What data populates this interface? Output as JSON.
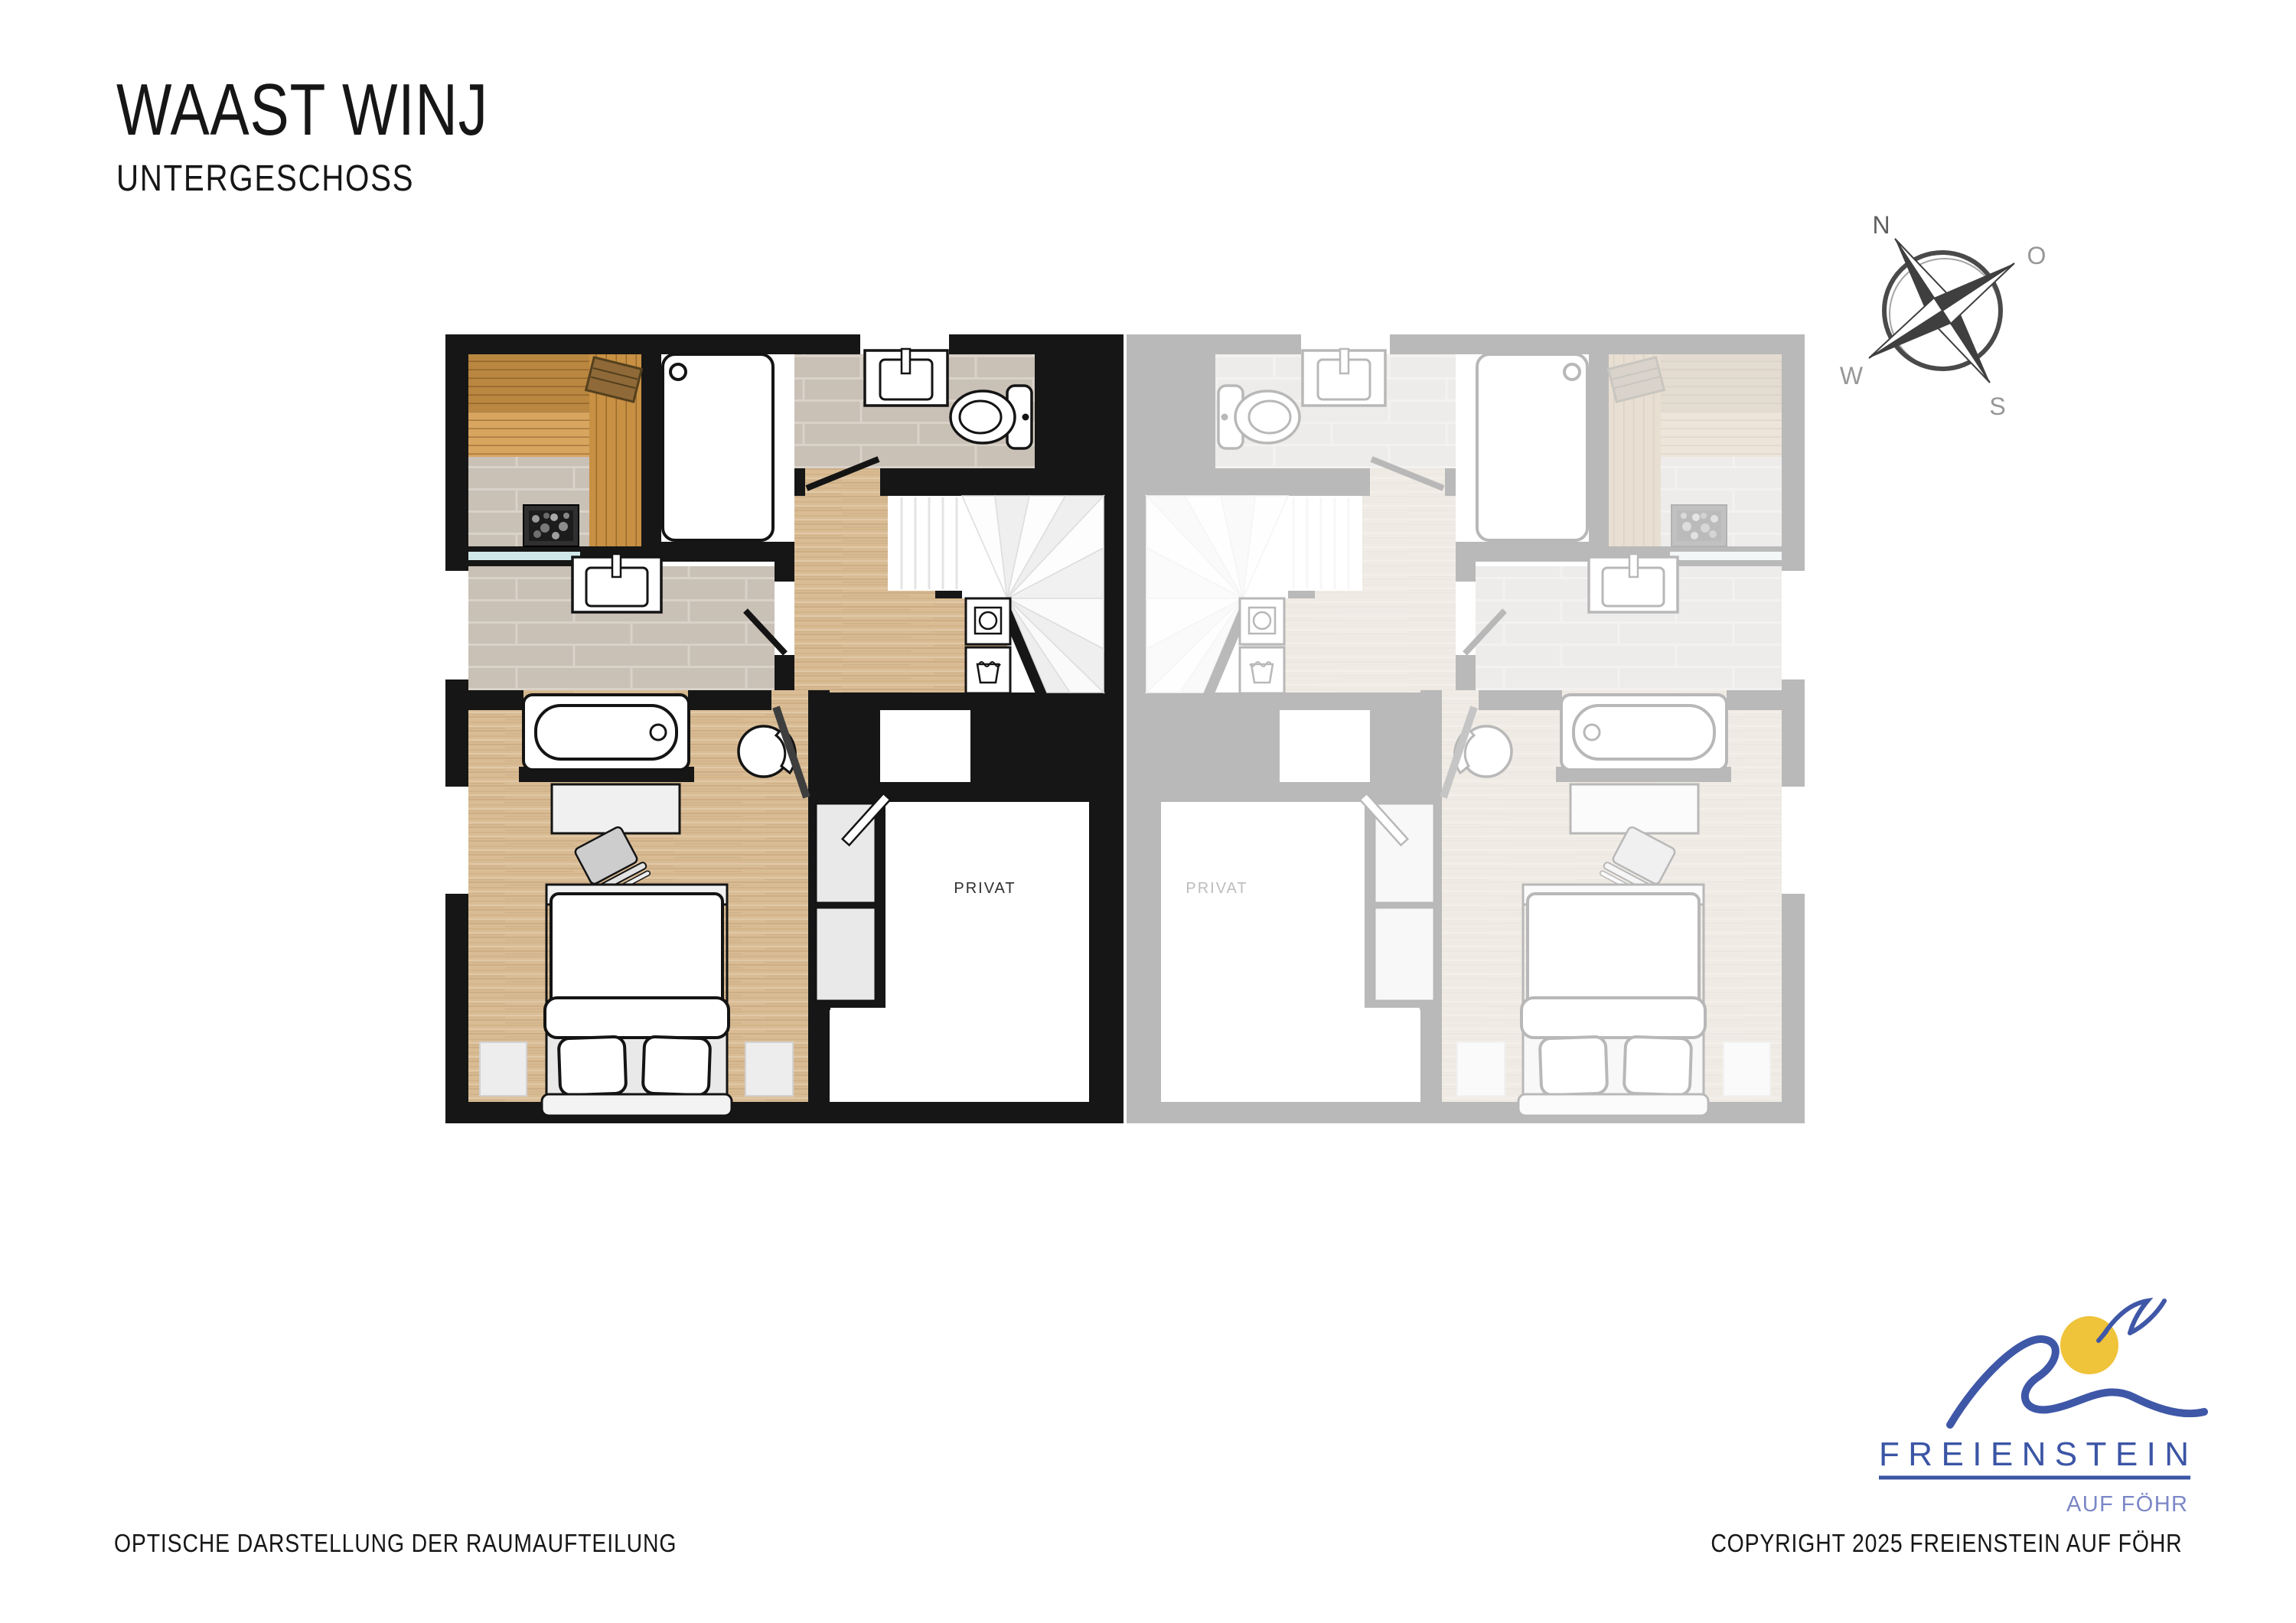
{
  "header": {
    "title": "WAAST WINJ",
    "subtitle": "UNTERGESCHOSS"
  },
  "compass": {
    "north": "N",
    "east": "O",
    "south": "S",
    "west": "W"
  },
  "floorplan": {
    "unit_label": "PRIVAT",
    "ghost_unit_label": "PRIVAT"
  },
  "logo": {
    "brand": "FREIENSTEIN",
    "tagline": "AUF FÖHR"
  },
  "footer": {
    "left": "OPTISCHE DARSTELLUNG DER RAUMAUFTEILUNG",
    "right": "COPYRIGHT 2025 FREIENSTEIN AUF FÖHR"
  },
  "colors": {
    "wall": "#161616",
    "wood_floor": "#d9bc94",
    "tile_floor": "#c9c0b6",
    "sauna_bench": "#c28b42",
    "glass_door": "#cfe7e9",
    "ghost_grey": "#c6c6c6",
    "logo_blue": "#3b55a5",
    "logo_yellow": "#efc33a"
  }
}
